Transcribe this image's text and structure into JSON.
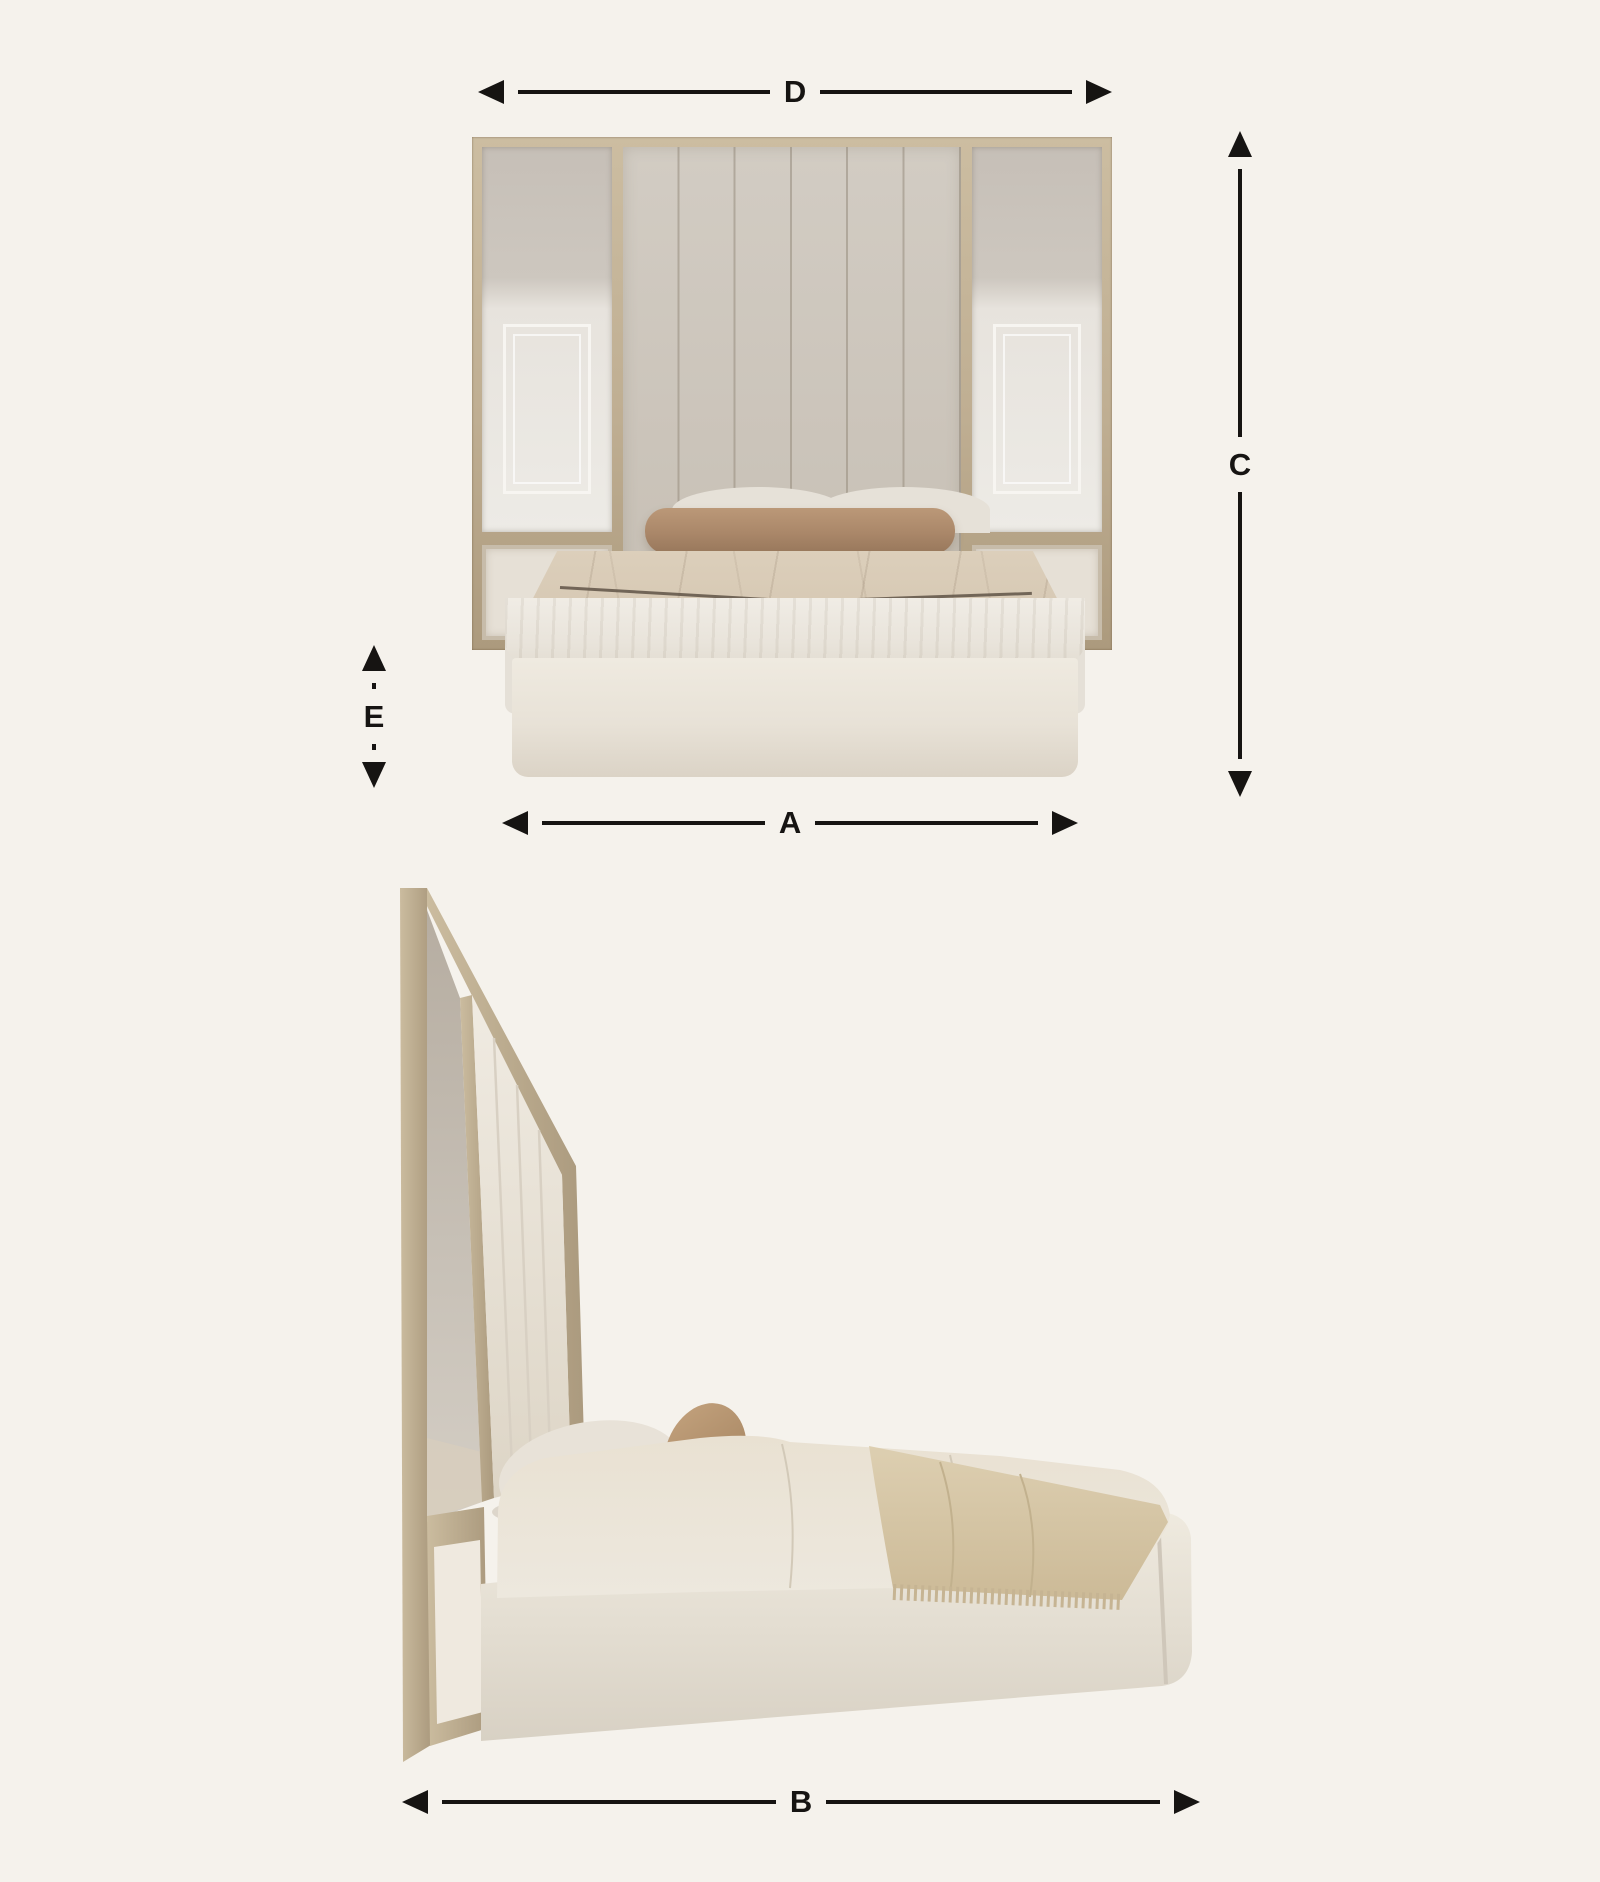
{
  "diagram": {
    "type": "furniture-dimensions",
    "subject": "upholstered bed with wide headboard wall panel, front and side views",
    "background_color": "#f5f2ec",
    "arrow_color": "#161412"
  },
  "labels": {
    "A": "A",
    "B": "B",
    "C": "C",
    "D": "D",
    "E": "E"
  },
  "dimension_lines": [
    {
      "label": "D",
      "orientation": "horizontal",
      "measures": "headboard panel width (front view, top)"
    },
    {
      "label": "C",
      "orientation": "vertical",
      "measures": "total height (front view, right)"
    },
    {
      "label": "E",
      "orientation": "vertical",
      "measures": "bed base height (front view, left)"
    },
    {
      "label": "A",
      "orientation": "horizontal",
      "measures": "bed width (front view, bottom)"
    },
    {
      "label": "B",
      "orientation": "horizontal",
      "measures": "bed length (side view, bottom)"
    }
  ],
  "colors": {
    "wood": "#bfae92",
    "mirror": "#cdc7bf",
    "upholstered_panel": "#cbc4ba",
    "lower_panel": "#e6e0d6",
    "bolster_pillow": "#aa8769",
    "sheet": "#d7c9b4",
    "duvet": "#e9e4db",
    "bed_base": "#e8e2d7",
    "throw_blanket": "#d5c4a4",
    "accent_cushion": "#b3906c"
  }
}
